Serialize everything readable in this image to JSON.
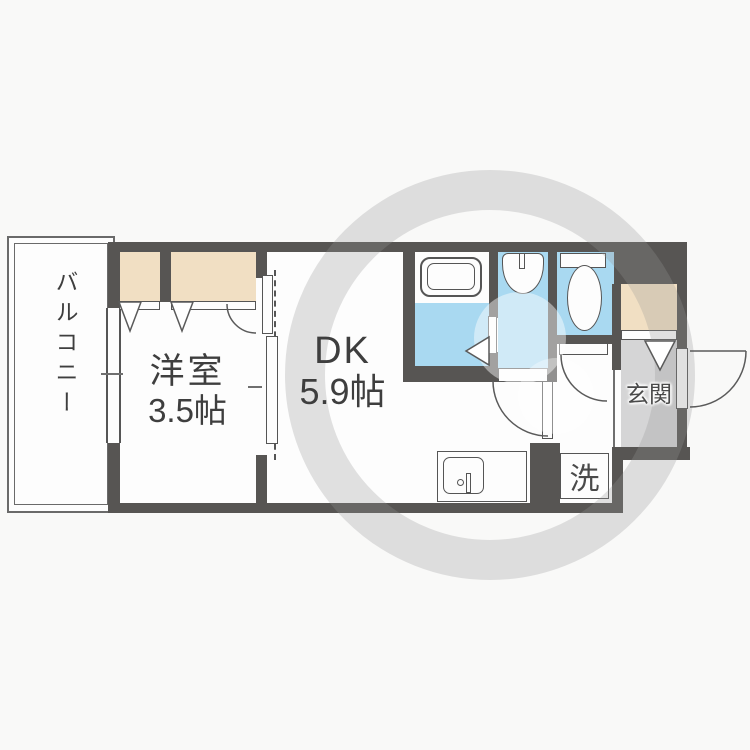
{
  "title": "apartment-floor-plan",
  "colors": {
    "wall": "#575553",
    "water_room": "#a9d9f1",
    "closet": "#f1dfc3",
    "genkan_floor": "#d5d5d6",
    "line": "#555555",
    "page_bg": "#f9f9f8",
    "floor_white": "#fdfdfd",
    "text": "#3e3e3e"
  },
  "rooms": {
    "balcony": {
      "label": "バルコニー"
    },
    "western_room": {
      "label": "洋室",
      "size": "3.5帖"
    },
    "dining_kitchen": {
      "label": "DK",
      "size": "5.9帖"
    },
    "entrance": {
      "label": "玄関"
    },
    "laundry": {
      "label": "洗"
    }
  }
}
